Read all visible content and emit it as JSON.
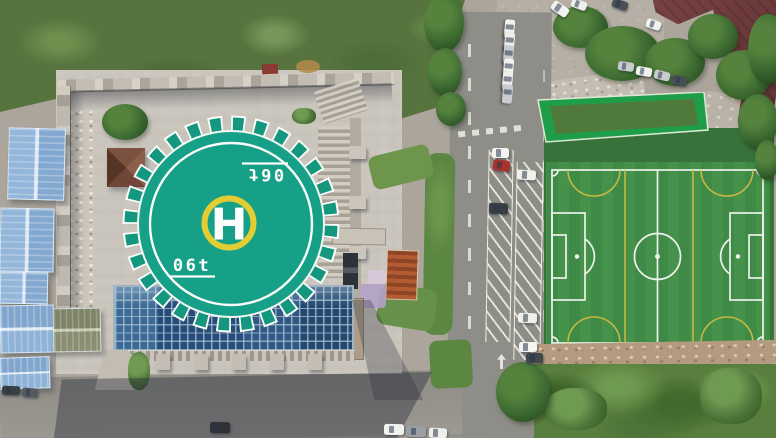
{
  "scene": {
    "type": "aerial-drone-photo",
    "caption": "Aerial view of a castle-style building with rooftop helipad, blue glass atrium roof, blue warehouse sheds, a tree-lined road with angled parking, and an artificial-turf soccer pitch"
  },
  "helipad": {
    "center_letter": "H",
    "weight_marking": "06t",
    "weight_marking_note": "marking painted twice, second instance rotated 180 degrees",
    "pad_color": "#16a087",
    "edge_ring_color": "#ffffff",
    "touchdown_ring_color": "#e3cd33",
    "letter_color": "#ffffff"
  },
  "soccer_field": {
    "turf_color": "#3f8a46",
    "primary_line_color": "#edf2ea",
    "secondary_line_color": "#c6b93f",
    "stand_roof_color": "#1f9e4a"
  },
  "palette": {
    "grass": "#57743e",
    "plaza_concrete": "#c7c1b6",
    "road_asphalt": "#8f8e88",
    "glass_roof_blue": "#2a5078",
    "shed_roof_blue": "#93b6da",
    "maroon_roof": "#6e3c3d",
    "pavilion_roof": "#7b5140",
    "tree_green": "#3f6d33",
    "dirt_strip": "#b49b7f"
  }
}
